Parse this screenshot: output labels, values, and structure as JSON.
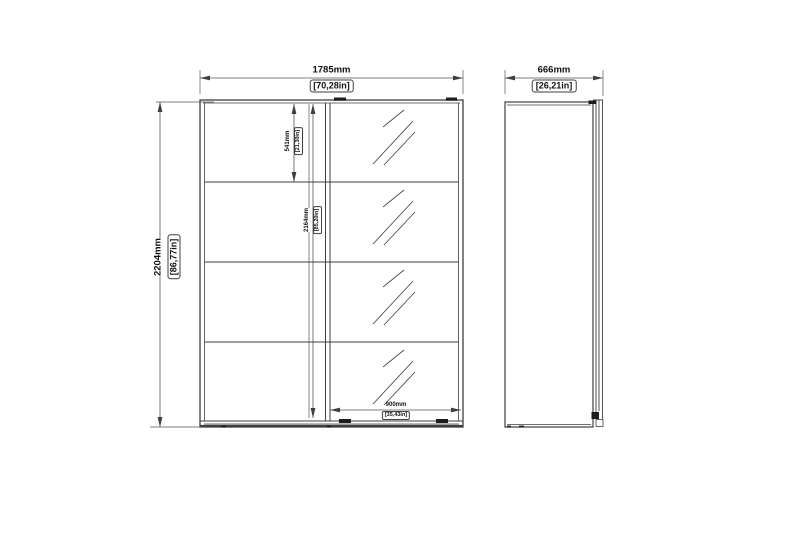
{
  "drawing_title": "wardrobe-technical-drawing",
  "dimensions": {
    "front_width": {
      "mm": "1785mm",
      "inches": "[70,28in]"
    },
    "depth": {
      "mm": "666mm",
      "inches": "[26,21in]"
    },
    "height": {
      "mm": "2204mm",
      "inches": "[86,77in]"
    },
    "top_section_height": {
      "mm": "541mm",
      "inches": "[21,30in]"
    },
    "door_height": {
      "mm": "2164mm",
      "inches": "[85,20in]"
    },
    "door_width": {
      "mm": "900mm",
      "inches": "[35,43in]"
    }
  },
  "colors": {
    "object_line": "#3f3f3f",
    "dimension_line": "#555555",
    "text": "#111111",
    "background": "#ffffff"
  }
}
